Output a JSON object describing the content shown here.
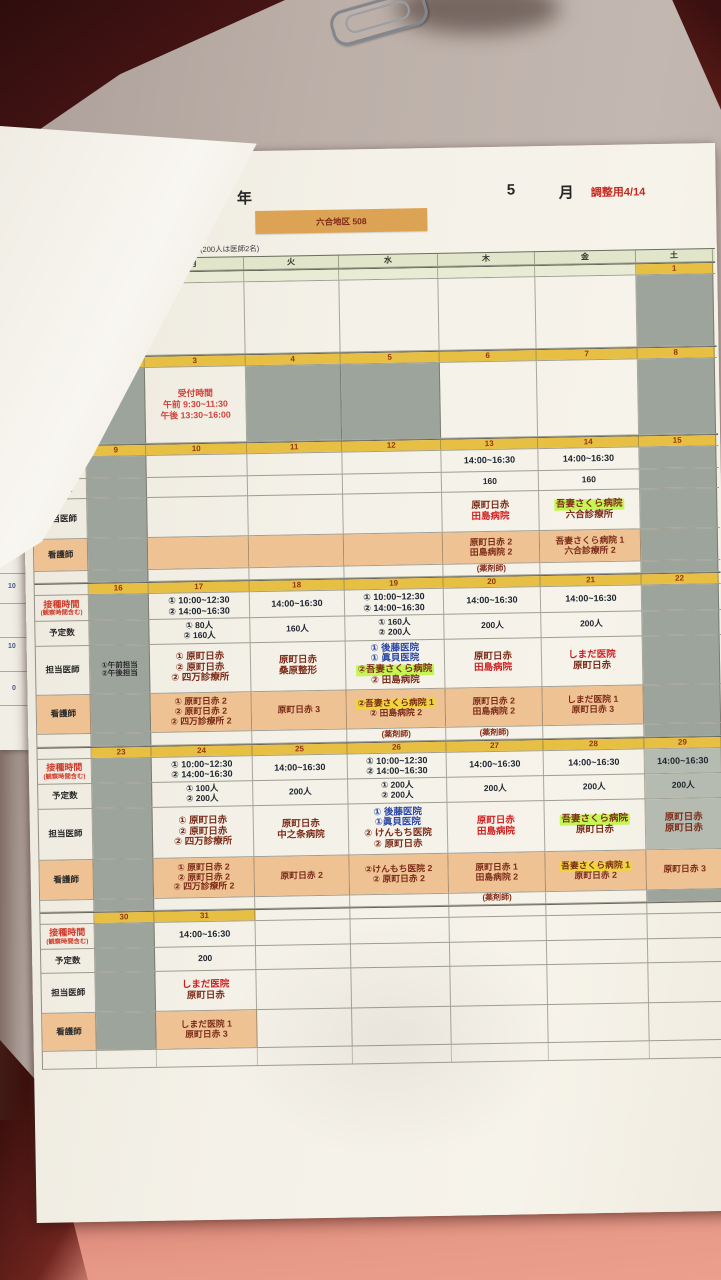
{
  "header": {
    "year_label": "年",
    "month_number": "5",
    "month_label": "月",
    "adjust_note": "調整用4/14",
    "district_banner": "六合地区 508",
    "staffing_note": "を基本とする。(200人は医師2名)"
  },
  "colors": {
    "date_band": "#e7bf43",
    "nurse_row": "#efc293",
    "gray_cell": "#9da49c",
    "highlight_green": "#c6f653",
    "highlight_yellow": "#efd53c",
    "doctor_red": "#d01f1f",
    "doctor_blue": "#2b47a8",
    "doctor_dark": "#7c2d1a",
    "banner_orange": "#dda355"
  },
  "calendar": {
    "weekday_header": [
      "日",
      "月",
      "火",
      "水",
      "木",
      "金",
      "土"
    ],
    "row_labels": {
      "time": "接種時間",
      "time_sub": "(観察時間含む)",
      "count": "予定数",
      "doctor": "担当医師",
      "nurse": "看護師",
      "pharmacist": "(薬剤師)"
    },
    "reception": {
      "title": "受付時間",
      "am": "午前 9:30~11:30",
      "pm": "午後 13:30~16:00"
    },
    "under_sheet_numbers": [
      "10",
      "10",
      "0"
    ],
    "weeks": [
      {
        "type": "plain",
        "band_all": false,
        "days": [
          {
            "date": ""
          },
          {
            "date": ""
          },
          {
            "date": ""
          },
          {
            "date": ""
          },
          {
            "date": ""
          },
          {
            "date": ""
          },
          {
            "date": "1",
            "band": true,
            "gray": true
          }
        ]
      },
      {
        "type": "plain",
        "band_all": true,
        "days": [
          {
            "date": "2",
            "gray": true
          },
          {
            "date": "3",
            "reception": true
          },
          {
            "date": "4",
            "gray": true
          },
          {
            "date": "5",
            "gray": true
          },
          {
            "date": "6"
          },
          {
            "date": "7"
          },
          {
            "date": "8",
            "gray": true
          }
        ]
      },
      {
        "type": "full",
        "band_all": true,
        "days": [
          {
            "date": "9",
            "gray": true
          },
          {
            "date": "10"
          },
          {
            "date": "11"
          },
          {
            "date": "12"
          },
          {
            "date": "13",
            "time": [
              "14:00~16:30"
            ],
            "count": [
              "160"
            ],
            "doctors": [
              {
                "t": "原町日赤",
                "c": "dark"
              },
              {
                "t": "田島病院",
                "c": "red"
              }
            ],
            "nurses": [
              {
                "t": "原町日赤 2"
              },
              {
                "t": "田島病院 2"
              }
            ],
            "pharm": true
          },
          {
            "date": "14",
            "time": [
              "14:00~16:30"
            ],
            "count": [
              "160"
            ],
            "doctors": [
              {
                "t": "吾妻さくら病院",
                "c": "dark",
                "hl": "green"
              },
              {
                "t": "六合診療所",
                "c": "dark"
              }
            ],
            "nurses": [
              {
                "t": "吾妻さくら病院 1"
              },
              {
                "t": "六合診療所 2"
              }
            ]
          },
          {
            "date": "15",
            "gray": true
          }
        ]
      },
      {
        "type": "full",
        "band_all": true,
        "days": [
          {
            "date": "16",
            "gray": true,
            "note": [
              "①午前担当",
              "②午後担当"
            ]
          },
          {
            "date": "17",
            "time": [
              "① 10:00~12:30",
              "② 14:00~16:30"
            ],
            "count": [
              "① 80人",
              "② 160人"
            ],
            "doctors": [
              {
                "t": "① 原町日赤",
                "c": "dark"
              },
              {
                "t": "② 原町日赤",
                "c": "dark"
              },
              {
                "t": "② 四万診療所",
                "c": "dark"
              }
            ],
            "nurses": [
              {
                "t": "① 原町日赤 2"
              },
              {
                "t": "② 原町日赤 2"
              },
              {
                "t": "② 四万診療所 2"
              }
            ]
          },
          {
            "date": "18",
            "time": [
              "14:00~16:30"
            ],
            "count": [
              "160人"
            ],
            "doctors": [
              {
                "t": "原町日赤",
                "c": "dark"
              },
              {
                "t": "桑原整形",
                "c": "dark"
              }
            ],
            "nurses": [
              {
                "t": "原町日赤 3"
              }
            ]
          },
          {
            "date": "19",
            "time": [
              "① 10:00~12:30",
              "② 14:00~16:30"
            ],
            "count": [
              "① 160人",
              "② 200人"
            ],
            "doctors": [
              {
                "t": "① 後藤医院",
                "c": "blue"
              },
              {
                "t": "① 眞貝医院",
                "c": "blue"
              },
              {
                "t": "②吾妻さくら病院",
                "c": "dark",
                "hl": "green"
              },
              {
                "t": "② 田島病院",
                "c": "dark"
              }
            ],
            "nurses": [
              {
                "t": "②吾妻さくら病院 1",
                "hl": "yellow"
              },
              {
                "t": "② 田島病院 2"
              }
            ],
            "pharm": true
          },
          {
            "date": "20",
            "time": [
              "14:00~16:30"
            ],
            "count": [
              "200人"
            ],
            "doctors": [
              {
                "t": "原町日赤",
                "c": "dark"
              },
              {
                "t": "田島病院",
                "c": "red"
              }
            ],
            "nurses": [
              {
                "t": "原町日赤 2"
              },
              {
                "t": "田島病院 2"
              }
            ],
            "pharm": true
          },
          {
            "date": "21",
            "time": [
              "14:00~16:30"
            ],
            "count": [
              "200人"
            ],
            "doctors": [
              {
                "t": "しまだ医院",
                "c": "red"
              },
              {
                "t": "原町日赤",
                "c": "dark"
              }
            ],
            "nurses": [
              {
                "t": "しまだ医院 1"
              },
              {
                "t": "原町日赤 3"
              }
            ]
          },
          {
            "date": "22",
            "gray": true
          }
        ]
      },
      {
        "type": "full",
        "band_all": true,
        "days": [
          {
            "date": "23",
            "gray": true
          },
          {
            "date": "24",
            "time": [
              "① 10:00~12:30",
              "② 14:00~16:30"
            ],
            "count": [
              "① 100人",
              "② 200人"
            ],
            "doctors": [
              {
                "t": "① 原町日赤",
                "c": "dark"
              },
              {
                "t": "② 原町日赤",
                "c": "dark"
              },
              {
                "t": "② 四万診療所",
                "c": "dark"
              }
            ],
            "nurses": [
              {
                "t": "① 原町日赤 2"
              },
              {
                "t": "② 原町日赤 2"
              },
              {
                "t": "② 四万診療所 2"
              }
            ]
          },
          {
            "date": "25",
            "time": [
              "14:00~16:30"
            ],
            "count": [
              "200人"
            ],
            "doctors": [
              {
                "t": "原町日赤",
                "c": "dark"
              },
              {
                "t": "中之条病院",
                "c": "dark"
              }
            ],
            "nurses": [
              {
                "t": "原町日赤 2"
              }
            ]
          },
          {
            "date": "26",
            "time": [
              "① 10:00~12:30",
              "② 14:00~16:30"
            ],
            "count": [
              "① 200人",
              "② 200人"
            ],
            "doctors": [
              {
                "t": "① 後藤医院",
                "c": "blue"
              },
              {
                "t": "①眞貝医院",
                "c": "blue"
              },
              {
                "t": "② けんもち医院",
                "c": "dark"
              },
              {
                "t": "② 原町日赤",
                "c": "dark"
              }
            ],
            "nurses": [
              {
                "t": "②けんもち医院 2"
              },
              {
                "t": "② 原町日赤 2"
              }
            ]
          },
          {
            "date": "27",
            "time": [
              "14:00~16:30"
            ],
            "count": [
              "200人"
            ],
            "doctors": [
              {
                "t": "原町日赤",
                "c": "red"
              },
              {
                "t": "田島病院",
                "c": "red"
              }
            ],
            "nurses": [
              {
                "t": "原町日赤 1"
              },
              {
                "t": "田島病院 2"
              }
            ],
            "pharm": true
          },
          {
            "date": "28",
            "time": [
              "14:00~16:30"
            ],
            "count": [
              "200人"
            ],
            "doctors": [
              {
                "t": "吾妻さくら病院",
                "c": "dark",
                "hl": "green"
              },
              {
                "t": "原町日赤",
                "c": "dark"
              }
            ],
            "nurses": [
              {
                "t": "吾妻さくら病院 1",
                "hl": "yellow"
              },
              {
                "t": "原町日赤 2"
              }
            ]
          },
          {
            "date": "29",
            "gray": true,
            "time": [
              "14:00~16:30"
            ],
            "count": [
              "200人"
            ],
            "doctors": [
              {
                "t": "原町日赤",
                "c": "dark"
              },
              {
                "t": "原町日赤",
                "c": "dark"
              }
            ],
            "nurses": [
              {
                "t": "原町日赤 3"
              }
            ]
          }
        ]
      },
      {
        "type": "full",
        "band_all": false,
        "days": [
          {
            "date": "30",
            "band": true,
            "gray": true
          },
          {
            "date": "31",
            "band": true,
            "time": [
              "14:00~16:30"
            ],
            "count": [
              "200"
            ],
            "doctors": [
              {
                "t": "しまだ医院",
                "c": "red"
              },
              {
                "t": "原町日赤",
                "c": "dark"
              }
            ],
            "nurses": [
              {
                "t": "しまだ医院 1"
              },
              {
                "t": "原町日赤 3"
              }
            ]
          },
          {
            "date": ""
          },
          {
            "date": ""
          },
          {
            "date": ""
          },
          {
            "date": ""
          },
          {
            "date": ""
          }
        ]
      }
    ]
  }
}
